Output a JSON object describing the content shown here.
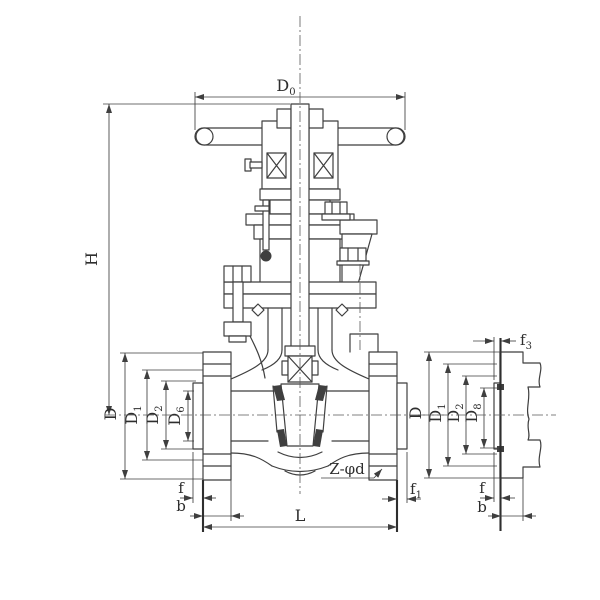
{
  "drawing": {
    "background": "#ffffff",
    "line_color": "#3f3f3f",
    "text_color": "#2e2e2e",
    "description": "Gate valve sectional engineering drawing with handwheel, bonnet, wedge, end flanges and a separate flange-face detail view",
    "main_view": {
      "dims": {
        "d0": {
          "base": "D",
          "sub": "0"
        },
        "h": {
          "base": "H",
          "sub": ""
        },
        "d": {
          "base": "D",
          "sub": ""
        },
        "d1": {
          "base": "D",
          "sub": "1"
        },
        "d2": {
          "base": "D",
          "sub": "2"
        },
        "d6": {
          "base": "D",
          "sub": "6"
        },
        "f": {
          "base": "f",
          "sub": ""
        },
        "b": {
          "base": "b",
          "sub": ""
        },
        "l": {
          "base": "L",
          "sub": ""
        },
        "f1": {
          "base": "f",
          "sub": "1"
        },
        "z_phi_d": {
          "base": "Z-φd",
          "sub": ""
        }
      }
    },
    "detail_view": {
      "dims": {
        "f3": {
          "base": "f",
          "sub": "3"
        },
        "d": {
          "base": "D",
          "sub": ""
        },
        "d1": {
          "base": "D",
          "sub": "1"
        },
        "d2": {
          "base": "D",
          "sub": "2"
        },
        "d8": {
          "base": "D",
          "sub": "8"
        },
        "f": {
          "base": "f",
          "sub": ""
        },
        "b": {
          "base": "b",
          "sub": ""
        }
      }
    }
  }
}
